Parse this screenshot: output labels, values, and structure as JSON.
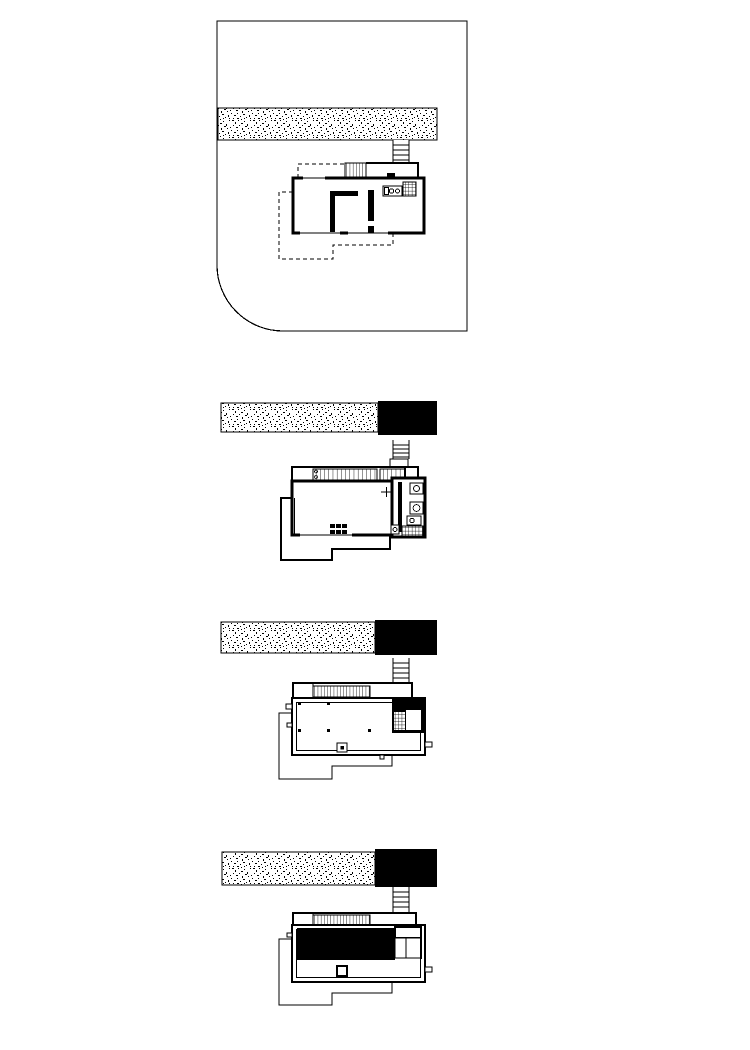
{
  "colors": {
    "background": "#ffffff",
    "ink": "#000000"
  },
  "panels": [
    {
      "label": "site-plan"
    },
    {
      "label": "floor-plan-entry-level"
    },
    {
      "label": "floor-plan-lower-level"
    },
    {
      "label": "roof-plan"
    }
  ],
  "textures": {
    "gravel_band": "stipple-dots",
    "stair": "vertical-hatch",
    "tile": "square-grid"
  }
}
